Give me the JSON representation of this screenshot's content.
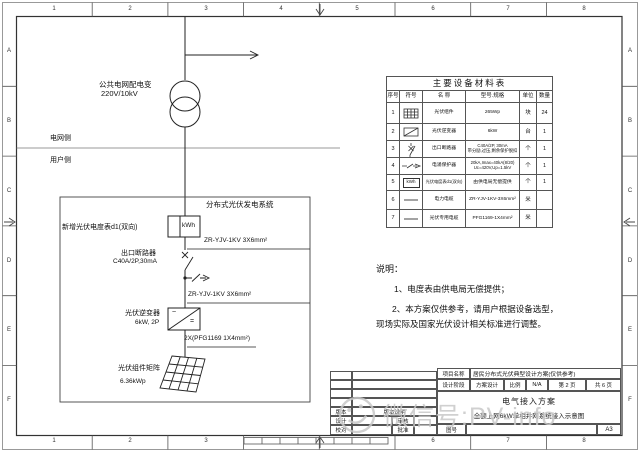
{
  "frame": {
    "top_labels": [
      "1",
      "2",
      "3",
      "4",
      "5",
      "6",
      "7",
      "8"
    ],
    "bottom_labels": [
      "1",
      "2",
      "3",
      "6",
      "7",
      "8"
    ],
    "left_labels": [
      "A",
      "B",
      "C",
      "D",
      "E",
      "F"
    ],
    "right_labels": [
      "A",
      "B",
      "C",
      "D",
      "E",
      "F"
    ]
  },
  "diagram": {
    "grid_transformer_name": "公共电网配电变",
    "grid_transformer_spec": "220V/10kV",
    "grid_side_label": "电网侧",
    "user_side_label": "用户侧",
    "pv_system_title": "分布式光伏发电系统",
    "meter_label": "新增光伏电度表d1(双向)",
    "meter_display": "kWh",
    "cable_ac1": "ZR-YJV-1KV 3X6mm²",
    "breaker_name": "出口断路器",
    "breaker_spec": "C40A/2P,30mA",
    "cable_ac2": "ZR-YJV-1KV 3X6mm²",
    "inverter_name": "光伏逆变器",
    "inverter_spec": "6kW, 2P",
    "cable_dc": "2X(PFG1169 1X4mm²)",
    "pv_array_name": "光伏组件矩阵",
    "pv_array_spec": "6.36kWp"
  },
  "equipment_table": {
    "title": "主要设备材料表",
    "headers": [
      "序号",
      "符号",
      "名 称",
      "型号.规格",
      "单位",
      "数量"
    ],
    "meter_symbol_text": "kWh",
    "rows": [
      {
        "no": "1",
        "name": "光伏组件",
        "spec1": "265Wp",
        "spec2": "",
        "unit": "块",
        "qty": "24"
      },
      {
        "no": "2",
        "name": "光伏逆变器",
        "spec1": "6kW",
        "spec2": "",
        "unit": "台",
        "qty": "1"
      },
      {
        "no": "3",
        "name": "出口断路器",
        "spec1": "C40A/2P, 30mA",
        "spec2": "带分励,过压,剩余保护脱扣",
        "unit": "个",
        "qty": "1"
      },
      {
        "no": "4",
        "name": "电涌保护器",
        "spec1": "20kA,Imax=40kA(8/20)",
        "spec2": "Uc=420V,Up=1.5kV",
        "unit": "个",
        "qty": "1"
      },
      {
        "no": "5",
        "name": "光伏电度表d1(双向)",
        "spec1": "由供电局无偿提供",
        "spec2": "",
        "unit": "个",
        "qty": "1"
      },
      {
        "no": "6",
        "name": "电力电缆",
        "spec1": "ZR-YJV-1KV-3X6mm²",
        "spec2": "",
        "unit": "米",
        "qty": ""
      },
      {
        "no": "7",
        "name": "光伏专用电缆",
        "spec1": "PFG1169-1X4mm²",
        "spec2": "",
        "unit": "米",
        "qty": ""
      }
    ]
  },
  "notes": {
    "title": "说明：",
    "line1": "1、电度表由供电局无偿提供；",
    "line2": "2、本方案仅供参考，请用户根据设备选型，",
    "line3": "现场实际及国家光伏设计相关标准进行调整。"
  },
  "title_block": {
    "project_label": "项目名称",
    "project_name": "居民分布式光伏典型设计方案(仅供参考)",
    "stage_label": "设计阶段",
    "stage_value": "方案设计",
    "scale_label": "比例",
    "scale_value": "N/A",
    "page_current": "第 2 页",
    "page_total": "共 6 页",
    "drawing_title_1": "电气接入方案",
    "drawing_title_2": "全额上网6kW单相并网系统接入示意图",
    "version_label": "版本",
    "version_note_label": "版本说明",
    "design_label": "设计",
    "review_label": "审核",
    "proof_label": "校对",
    "approve_label": "批准",
    "drawing_no_label": "图号",
    "paper_size": "A3"
  },
  "watermark": {
    "text": "微信号:PV-info"
  }
}
